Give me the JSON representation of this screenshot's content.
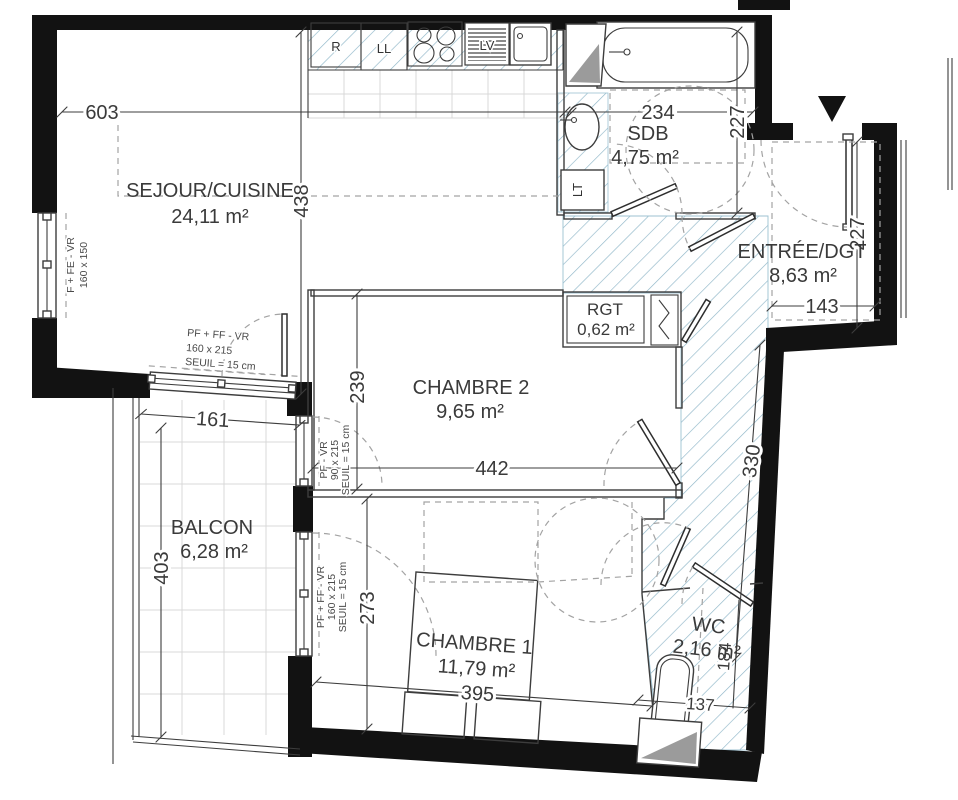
{
  "title": "floor-plan",
  "colors": {
    "wall": "#121212",
    "hatch_blue": "#8fb6c8",
    "line": "#3d3d3d",
    "dash_grey": "#a3a3a3",
    "grid_grey": "#d9d9d9",
    "text": "#3a3a3a",
    "fixture_grey": "#9b9b9b"
  },
  "rooms": {
    "sejour": {
      "name": "SEJOUR/CUISINE",
      "area": "24,11 m²"
    },
    "sdb": {
      "name": "SDB",
      "area": "4,75 m²"
    },
    "entree": {
      "name": "ENTRÉE/DGT",
      "area": "8,63 m²"
    },
    "rgt": {
      "name": "RGT",
      "area": "0,62 m²"
    },
    "chambre2": {
      "name": "CHAMBRE 2",
      "area": "9,65 m²"
    },
    "balcon": {
      "name": "BALCON",
      "area": "6,28 m²"
    },
    "chambre1": {
      "name": "CHAMBRE 1",
      "area": "11,79 m²"
    },
    "wc": {
      "name": "WC",
      "area": "2,16 m²"
    }
  },
  "dims": {
    "sejour_width": "603",
    "sejour_depth": "438",
    "sdb_width": "234",
    "sdb_depth": "227",
    "entree_depth": "227",
    "entree_width": "143",
    "balcon_width": "161",
    "balcon_depth": "403",
    "chambre2_depth": "239",
    "chambre2_width": "442",
    "degagement_depth": "330",
    "chambre1_depth": "273",
    "chambre1_width": "395",
    "wc_width": "137",
    "wc_depth": "184"
  },
  "appliances": {
    "refrigerator": "R",
    "washing_machine": "LL",
    "dishwasher": "LV",
    "laundry_tub": "LT"
  },
  "windows": {
    "sejour_window": {
      "l1": "F + FE - VR",
      "l2": "160 x 150"
    },
    "balcon_door": {
      "l1": "PF + FF - VR",
      "l2": "160 x 215",
      "l3": "SEUIL = 15 cm"
    },
    "chambre2_window": {
      "l1": "PF - VR",
      "l2": "90 x 215",
      "l3": "SEUIL = 15 cm"
    },
    "chambre1_window": {
      "l1": "PF + FF - VR",
      "l2": "160 x 215",
      "l3": "SEUIL = 15 cm"
    }
  }
}
